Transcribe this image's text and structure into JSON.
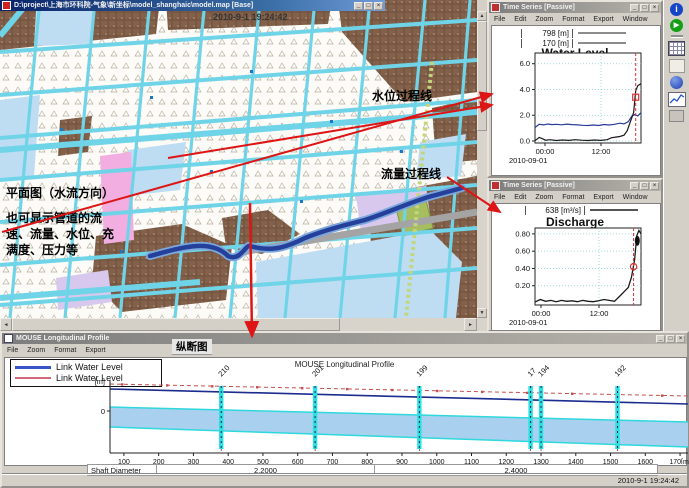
{
  "map_window": {
    "title": "D:\\project\\上海市环科院-气象\\新坐标\\model_shanghaic\\model.map [Base]",
    "timestamp_overlay": "2010-9-1 19:24:42",
    "annotations": {
      "plan_view": "平面图（水流方向）",
      "pipe_info_l1": "也可显示管道的流",
      "pipe_info_l2": "速、流量、水位、充",
      "pipe_info_l3": "满度、压力等",
      "water_level_label": "水位过程线",
      "discharge_label": "流量过程线"
    }
  },
  "water_level_window": {
    "title": "Time Series [Passive]",
    "menu": [
      "File",
      "Edit",
      "Zoom",
      "Format",
      "Export",
      "Window"
    ]
  },
  "discharge_window": {
    "title": "Time Series [Passive]",
    "menu": [
      "File",
      "Edit",
      "Zoom",
      "Format",
      "Export",
      "Window"
    ]
  },
  "profile_window": {
    "title": "MOUSE Longitudinal Profile",
    "menu": [
      "File",
      "Zoom",
      "Format",
      "Export"
    ],
    "section_label": "纵断图",
    "status_time": "2010-9-1 19:24:42"
  },
  "chart_data": [
    {
      "id": "water_level",
      "type": "line",
      "title": "Water Level",
      "legend": [
        {
          "label": "798 [m]",
          "color": "#8c8c8c"
        },
        {
          "label": "170 [m]",
          "color": "#8c8c8c"
        }
      ],
      "x_ticks": [
        "00:00",
        "12:00"
      ],
      "x_date": "2010-09-01",
      "ylim": [
        0,
        6.6
      ],
      "y_ticks": [
        {
          "v": 6.0,
          "label": "6.0"
        },
        {
          "v": 4.0,
          "label": "4.0"
        },
        {
          "v": 2.0,
          "label": "2.0"
        },
        {
          "v": 0.0,
          "label": "0.0"
        }
      ],
      "series": [
        {
          "name": "798 [m]",
          "color": "#2b3a9e",
          "width": 1.2,
          "x": [
            0,
            0.04,
            0.08,
            0.12,
            0.16,
            0.2,
            0.25,
            0.3,
            0.35,
            0.4,
            0.45,
            0.5,
            0.55,
            0.6,
            0.65,
            0.7,
            0.75,
            0.8,
            0.84,
            0.88,
            0.91,
            0.94,
            0.97,
            1
          ],
          "y": [
            1.05,
            1.3,
            1.25,
            1.32,
            1.27,
            1.3,
            1.26,
            1.31,
            1.27,
            1.25,
            1.22,
            1.2,
            1.24,
            1.2,
            1.28,
            1.24,
            1.3,
            1.38,
            1.33,
            1.5,
            1.9,
            2.05,
            1.95,
            2.2
          ]
        },
        {
          "name": "170 [m]",
          "color": "#1a1a1a",
          "width": 1.2,
          "x": [
            0,
            0.04,
            0.07,
            0.1,
            0.14,
            0.2,
            0.26,
            0.32,
            0.38,
            0.44,
            0.5,
            0.56,
            0.62,
            0.68,
            0.72,
            0.76,
            0.8,
            0.84,
            0.87,
            0.9,
            0.93,
            0.95,
            0.97,
            1
          ],
          "y": [
            0.02,
            0.28,
            0.18,
            0.06,
            0.1,
            0.04,
            0.08,
            0.05,
            0.1,
            0.06,
            0.04,
            0.08,
            0.05,
            0.1,
            0.25,
            0.3,
            0.35,
            0.45,
            0.8,
            1.5,
            2.2,
            3.9,
            4.3,
            4.45
          ]
        }
      ],
      "cursor": {
        "frac": 0.95,
        "value": 3.4,
        "color": "#d23333",
        "marker": "square"
      }
    },
    {
      "id": "discharge",
      "type": "line",
      "title": "Discharge",
      "legend": [
        {
          "label": "638 [m³/s]",
          "color": "#555555"
        }
      ],
      "x_ticks": [
        "00:00",
        "12:00"
      ],
      "x_date": "2010-09-01",
      "ylim": [
        0,
        0.85
      ],
      "y_ticks": [
        {
          "v": 0.8,
          "label": "0.80"
        },
        {
          "v": 0.6,
          "label": "0.60"
        },
        {
          "v": 0.4,
          "label": "0.40"
        },
        {
          "v": 0.2,
          "label": "0.20"
        }
      ],
      "series": [
        {
          "name": "638 [m³/s]",
          "color": "#1a1a1a",
          "width": 1.3,
          "x": [
            0,
            0.05,
            0.1,
            0.15,
            0.2,
            0.25,
            0.3,
            0.35,
            0.4,
            0.45,
            0.5,
            0.55,
            0.6,
            0.65,
            0.7,
            0.75,
            0.8,
            0.84,
            0.88,
            0.91,
            0.94,
            0.96,
            0.98,
            1
          ],
          "y": [
            0.01,
            0.04,
            0.02,
            0.03,
            0.015,
            0.03,
            0.02,
            0.025,
            0.015,
            0.03,
            0.02,
            0.015,
            0.025,
            0.04,
            0.03,
            0.02,
            0.08,
            0.13,
            0.18,
            0.3,
            0.5,
            0.78,
            0.84,
            0.8
          ]
        }
      ],
      "blob": [
        0.965,
        0.72
      ],
      "cursor": {
        "frac": 0.93,
        "value": 0.42,
        "color": "#d23333",
        "marker": "circle"
      }
    },
    {
      "id": "longitudinal_profile",
      "type": "area",
      "title": "MOUSE Longitudinal Profile",
      "ylabel": "[m]",
      "y_zero_label": "0",
      "x_ticks": [
        {
          "m": 100,
          "label": "100"
        },
        {
          "m": 200,
          "label": "200"
        },
        {
          "m": 300,
          "label": "300"
        },
        {
          "m": 400,
          "label": "400"
        },
        {
          "m": 500,
          "label": "500"
        },
        {
          "m": 600,
          "label": "600"
        },
        {
          "m": 700,
          "label": "700"
        },
        {
          "m": 800,
          "label": "800"
        },
        {
          "m": 900,
          "label": "900"
        },
        {
          "m": 1000,
          "label": "1000"
        },
        {
          "m": 1100,
          "label": "1100"
        },
        {
          "m": 1200,
          "label": "1200"
        },
        {
          "m": 1300,
          "label": "1300"
        },
        {
          "m": 1400,
          "label": "1400"
        },
        {
          "m": 1500,
          "label": "1500"
        },
        {
          "m": 1600,
          "label": "1600"
        },
        {
          "m": 1700,
          "label": "170[m]"
        }
      ],
      "nodes": [
        {
          "label": "210",
          "m": 380
        },
        {
          "label": "201",
          "m": 650
        },
        {
          "label": "199",
          "m": 950
        },
        {
          "label": "17",
          "m": 1270
        },
        {
          "label": "194",
          "m": 1300
        },
        {
          "label": "192",
          "m": 1520
        }
      ],
      "legend": [
        {
          "label": "Link Water Level",
          "color": "#3a55c8"
        },
        {
          "label": "Link Water Level",
          "color": "#d06a7a"
        }
      ],
      "max_level_color": "#c45050",
      "water_level_color": "#1b2b8e",
      "pipe_fill": "#a9d0ef",
      "pipe_edge": "#2fd8dc",
      "shaft_table": {
        "label": "Shaft Diameter",
        "seg1": "2.2000",
        "seg2": "2.4000"
      }
    }
  ]
}
